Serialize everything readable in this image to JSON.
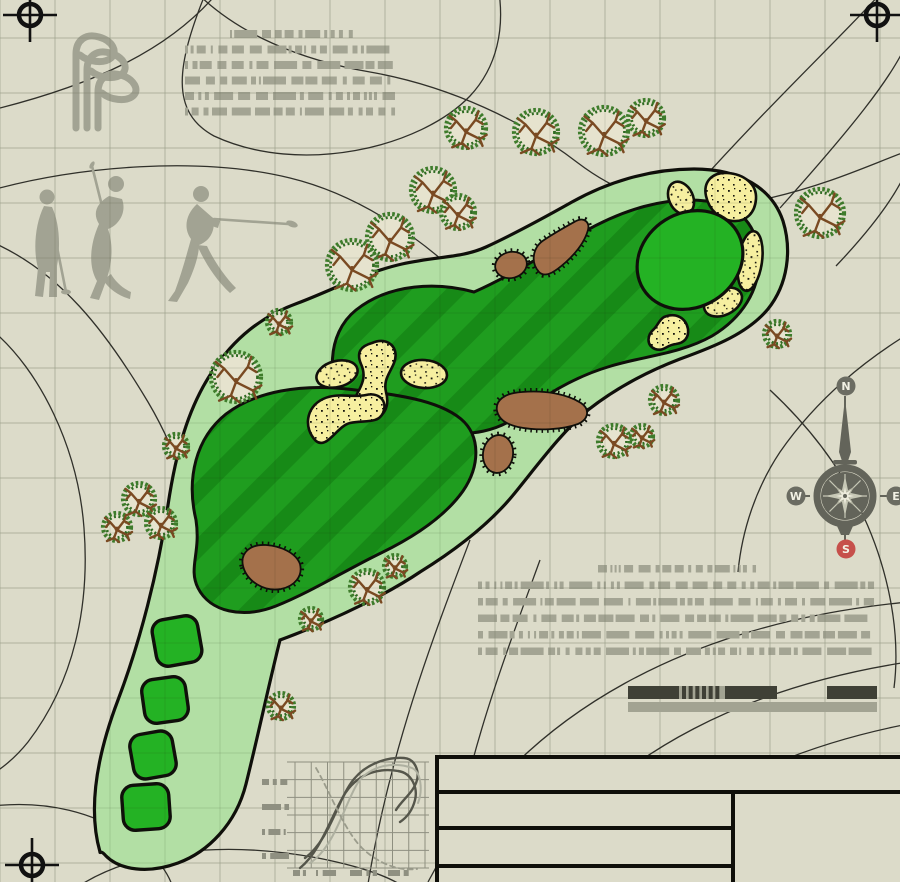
{
  "canvas": {
    "width": 900,
    "height": 882,
    "bg": "#dcdbc9"
  },
  "colors": {
    "grid": "#c9cab7",
    "grid_overlay": "#1c2a10",
    "contour": "#30302a",
    "art_gray": "#a2a393",
    "redacted_gray": "#a3a493",
    "rough": "#b2dfa4",
    "fairway": "#1f9d1f",
    "fairway_stripe": "#178a17",
    "green": "#24b224",
    "sand": "#f6efa0",
    "mound_brown": "#a4714b",
    "outline_black": "#0f0f0a",
    "compass_body": "#63645a",
    "compass_badge": "#6b6c62",
    "compass_south": "#c6504b",
    "badge_text": "#f2f1e4",
    "scale_dark": "#3f4036",
    "scale_light": "#a2a392",
    "chart_dark": "#55564b",
    "chart_light": "#aeb0a0",
    "chart_dashed": "#9b9c8c",
    "tree_ring": "#3e7c2b",
    "tree_ring2": "#2f6b22",
    "tree_branch": "#7a4a22",
    "tree_fill": "#e6e3ce"
  },
  "grid": {
    "spacing": 55,
    "offset_x": 0,
    "offset_y": 38
  },
  "crosshairs": [
    {
      "x": 30,
      "y": 15
    },
    {
      "x": 877,
      "y": 15
    },
    {
      "x": 32,
      "y": 865
    }
  ],
  "contours": [
    "M0 108 C90 85,168 52,218 -8",
    "M206 -8 C176 66,170 112,214 136 C300 176,420 148,470 96 C498 66,504 28,499 -8",
    "M196 -8 C238 34,300 60,370 72 C450 86,525 122,578 163 C640 210,700 214,770 198 C830 184,872 164,905 152",
    "M-8 190 C80 166,200 156,290 178 C360 195,425 240,472 288",
    "M-8 242 C60 272,105 330,148 402 C180 456,200 520,205 584",
    "M-8 330 C40 370,78 448,84 528 C90 606,74 682,28 742 C12 762,-4 772,-8 774",
    "M-8 806 C46 800,96 812,134 840 C158 858,170 874,174 892",
    "M70 892 C128 850,220 840,318 858 C368 868,398 880,410 892",
    "M700 182 C778 96,838 40,882 -8",
    "M780 208 C848 132,894 76,908 40",
    "M836 266 C874 226,900 190,910 162",
    "M908 334 C856 366,812 406,780 452 C756 488,742 530,738 572",
    "M770 390 C828 444,868 508,886 580 C896 620,898 656,894 688",
    "M428 882 C520 706,700 622,908 602",
    "M520 884 C610 744,764 684,908 662",
    "M600 886 C684 788,806 744,908 724",
    "M470 540 C432 640,390 750,368 884",
    "M540 560 C500 670,462 770,448 884"
  ],
  "clubs_icon": {
    "stroke_width": 7,
    "paths": [
      "M76 128 L76 54 C76 40,86 33,99 37 C113 41,118 52,111 58 C104 64,88 62,80 55",
      "M87 128 L87 70 C87 56,97 49,110 53 C124 57,129 68,122 74 C115 80,99 78,91 71",
      "M98 128 L98 92 C98 78,108 71,121 75 C134 79,140 90,133 96 C126 102,110 100,102 93"
    ]
  },
  "golfers": [
    {
      "head": [
        47,
        197,
        7.5
      ],
      "paths": [
        "M44 206 C35 224,33 250,38 268 L35 296 L43 297 L46 272 L50 272 L49 297 L57 297 L57 266 C61 244,59 222,52 207 Z",
        "M45 213 C51 221,55 231,57 243 L52 246 C49 233,45 224,41 219 Z"
      ],
      "club": [
        57,
        247,
        66,
        292
      ],
      "club_head": [
        66,
        292,
        5,
        2.5,
        0
      ]
    },
    {
      "head": [
        116,
        184,
        8
      ],
      "paths": [
        "M109 196 C97 203,92 213,99 224 C90 244,88 266,97 281 L90 298 L99 300 L106 281 C113 262,113 243,108 229 C119 225,127 212,122 199 Z",
        "M103 280 C110 290,119 296,130 299 L131 292 C122 288,115 281,111 274 Z",
        "M111 199 C106 205,103 210,103 215 L109 219 C113 213,116 207,117 202 Z"
      ],
      "club": [
        104,
        214,
        92,
        166
      ],
      "club_head": [
        92,
        165,
        4,
        2,
        -60
      ]
    },
    {
      "head": [
        201,
        194,
        8
      ],
      "paths": [
        "M197 204 C186 214,183 228,191 239 C186 257,181 275,175 291 L168 301 L177 302 L188 283 C195 268,199 254,199 245 C210 241,216 230,213 218 Z",
        "M201 211 C208 215,214 219,220 221 L218 228 C210 226,203 221,198 217 Z",
        "M197 245 C205 263,216 280,230 293 L236 288 C224 276,213 259,207 246 Z"
      ],
      "club": [
        214,
        219,
        288,
        224
      ],
      "club_head": [
        292,
        224,
        6,
        3,
        20
      ]
    }
  ],
  "redacted_blocks": [
    {
      "name": "notes-top-left",
      "x": 185,
      "y": 30,
      "w": 210,
      "lines": 6,
      "lh": 8,
      "gap": 7.5,
      "first_inset_left": 45,
      "first_inset_right": 40,
      "seed": 7
    },
    {
      "name": "notes-mid-right",
      "x": 478,
      "y": 565,
      "w": 396,
      "lines": 6,
      "lh": 7.5,
      "gap": 9,
      "first_inset_left": 120,
      "first_inset_right": 118,
      "seed": 13
    }
  ],
  "course": {
    "rough_path": "M100 852 C88 810,96 758,118 700 C140 642,158 572,168 505 C176 452,188 408,212 372 C234 338,262 316,298 303 C330 291,366 272,402 264 C438 256,462 258,486 247 C512 235,540 220,572 202 C606 183,648 169,694 169 C740 169,772 188,783 221 C792 250,788 284,768 309 C748 333,716 346,680 359 C646 372,616 388,588 410 C562 432,540 462,514 494 C492 521,462 546,420 572 C392 591,340 618,280 640 C268 688,258 736,246 784 C236 824,208 852,178 863 C148 874,120 870,106 856 C100 849,100 854,100 852 Z",
    "fairways": [
      "M348 410 C326 382,326 334,356 310 C390 283,438 282,474 292 C506 278,542 256,582 233 C622 210,666 196,706 201 C742 205,758 228,759 258 C760 290,742 318,712 336 C680 354,644 356,611 366 C577 376,549 392,524 412 C499 431,469 438,439 430 C409 422,374 421,348 410 Z",
      "M196 520 C186 478,196 438,226 414 C256 391,302 384,347 389 C392 394,437 399,461 419 C481 436,480 466,463 491 C446 515,416 536,381 553 C346 570,311 592,276 606 C243 619,210 612,198 588 C188 568,201 553,196 520 Z"
    ],
    "green": {
      "cx": 690,
      "cy": 260,
      "rx": 55,
      "ry": 47,
      "rot": -32
    },
    "tees": [
      {
        "cx": 177,
        "cy": 641,
        "w": 46,
        "h": 47,
        "rot": -10
      },
      {
        "cx": 165,
        "cy": 700,
        "w": 44,
        "h": 44,
        "rot": -8
      },
      {
        "cx": 153,
        "cy": 755,
        "w": 43,
        "h": 45,
        "rot": -10
      },
      {
        "cx": 146,
        "cy": 807,
        "w": 47,
        "h": 45,
        "rot": -4
      }
    ],
    "bunkers": [
      {
        "type": "ellipse",
        "cx": 337,
        "cy": 374,
        "rx": 21,
        "ry": 13,
        "rot": -15
      },
      {
        "type": "path",
        "d": "M372 343 C388 336,400 348,394 363 C390 373,383 380,386 392 C390 406,384 419,371 418 C357 417,351 404,358 392 C363 383,366 375,361 364 C356 352,361 346,372 343 Z"
      },
      {
        "type": "ellipse",
        "cx": 424,
        "cy": 374,
        "rx": 23,
        "ry": 14,
        "rot": 4
      },
      {
        "type": "path",
        "d": "M316 441 C303 428,306 407,323 399 C338 392,352 398,366 395 C379 392,388 401,383 413 C378 424,364 420,350 423 C337 426,327 450,316 441 Z"
      },
      {
        "type": "ellipse",
        "cx": 681,
        "cy": 198,
        "rx": 12,
        "ry": 17,
        "rot": -25
      },
      {
        "type": "path",
        "d": "M706 196 C703 182,712 172,727 173 C744 174,757 184,756 199 C755 213,746 222,733 221 C720 220,709 210,706 196 Z"
      },
      {
        "type": "ellipse",
        "cx": 750,
        "cy": 261,
        "rx": 12,
        "ry": 30,
        "rot": 8
      },
      {
        "type": "ellipse",
        "cx": 723,
        "cy": 302,
        "rx": 20,
        "ry": 13,
        "rot": -25
      },
      {
        "type": "path",
        "d": "M664 317 C676 312,686 318,688 329 C689 338,684 343,676 344 C666 345,664 352,655 349 C646 345,647 335,654 329 C658 325,659 320,664 317 Z"
      }
    ],
    "mounds": [
      {
        "type": "path",
        "d": "M539 272 C530 262,533 247,544 240 C556 232,567 226,576 221 C584 217,590 222,588 230 C585 241,577 252,566 262 C557 270,546 279,539 272 Z"
      },
      {
        "type": "ellipse",
        "cx": 511,
        "cy": 265,
        "rx": 16,
        "ry": 13,
        "rot": -15
      },
      {
        "type": "path",
        "d": "M497 411 C495 400,505 393,522 392 C545 390,567 394,581 403 C590 409,589 419,578 424 C562 430,537 431,518 427 C505 424,499 419,497 411 Z"
      },
      {
        "type": "ellipse",
        "cx": 498,
        "cy": 454,
        "rx": 15,
        "ry": 19,
        "rot": 8
      },
      {
        "type": "path",
        "d": "M243 566 C240 553,250 544,266 545 C281 546,296 553,300 564 C303 576,295 586,281 589 C265 592,247 582,243 566 Z"
      }
    ],
    "trees": [
      [
        466,
        128,
        22
      ],
      [
        536,
        132,
        24
      ],
      [
        604,
        131,
        26
      ],
      [
        646,
        118,
        20
      ],
      [
        433,
        190,
        24
      ],
      [
        458,
        212,
        19
      ],
      [
        390,
        237,
        25
      ],
      [
        352,
        265,
        27
      ],
      [
        279,
        322,
        14
      ],
      [
        820,
        213,
        26
      ],
      [
        777,
        334,
        15
      ],
      [
        664,
        400,
        16
      ],
      [
        614,
        441,
        18
      ],
      [
        642,
        436,
        13
      ],
      [
        236,
        377,
        27
      ],
      [
        176,
        446,
        14
      ],
      [
        139,
        499,
        18
      ],
      [
        117,
        527,
        16
      ],
      [
        161,
        523,
        17
      ],
      [
        367,
        587,
        19
      ],
      [
        395,
        566,
        13
      ],
      [
        311,
        619,
        13
      ],
      [
        281,
        706,
        15
      ]
    ]
  },
  "compass": {
    "cx": 845,
    "cy": 496,
    "ring_r": 28,
    "labels": {
      "north": "N",
      "east": "E",
      "south": "S",
      "west": "W"
    },
    "badge_n": [
      846,
      386
    ],
    "badge_w": [
      796,
      496
    ],
    "badge_e": [
      896,
      496
    ],
    "badge_s": [
      846,
      549
    ],
    "badge_r": 9.5
  },
  "scale_bar": {
    "y": 686,
    "h": 13,
    "dark_segments": [
      {
        "x": 628,
        "w": 51
      },
      {
        "x": 725,
        "w": 52
      },
      {
        "x": 827,
        "w": 50
      }
    ],
    "stripe_zone": {
      "x": 679,
      "w": 46,
      "bars": 6
    },
    "lower_bar": {
      "x": 628,
      "y": 702,
      "w": 249,
      "h": 10
    }
  },
  "profile_chart": {
    "x": 295,
    "y": 762,
    "w": 130,
    "h": 106,
    "cols": 8,
    "rows": 6,
    "grid_color": "#8e8f80",
    "y_label_x": 262,
    "y_label_w": 27,
    "y_label_rows": [
      782,
      807,
      832,
      856
    ],
    "x_label_y": 870,
    "x_labels": [
      {
        "x": 293,
        "w": 13
      },
      {
        "x": 316,
        "w": 20
      },
      {
        "x": 350,
        "w": 27
      },
      {
        "x": 388,
        "w": 24
      }
    ],
    "series": [
      {
        "name": "profile-a",
        "color": "#55564b",
        "width": 2.4,
        "dash": "",
        "path": "M305 858 C330 840,338 798,354 779 C368 762,390 757,404 758 C416 759,419 772,417 780 C414 792,402 800,396 810"
      },
      {
        "name": "profile-b",
        "color": "#55564b",
        "width": 2.4,
        "dash": "",
        "path": "M300 868 C322 850,332 813,346 792 C360 772,381 768,398 771 C412 773,418 788,415 800 C412 812,406 818,400 822"
      },
      {
        "name": "profile-c",
        "color": "#aeb0a0",
        "width": 2,
        "dash": "",
        "path": "M310 863 C336 846,346 799,359 781 C373 764,396 762,412 768 C421 772,423 790,418 803"
      },
      {
        "name": "profile-d",
        "color": "#9b9c8c",
        "width": 1.8,
        "dash": "5 4",
        "path": "M316 768 C330 792,344 830,362 848 C380 865,400 871,417 869"
      }
    ]
  },
  "title_block": {
    "x": 437,
    "y": 757,
    "w": 467,
    "h": 129,
    "stroke_width": 4,
    "banner_divider_y": 792,
    "left_col_right": 733,
    "left_row_lines": [
      828,
      866
    ]
  }
}
